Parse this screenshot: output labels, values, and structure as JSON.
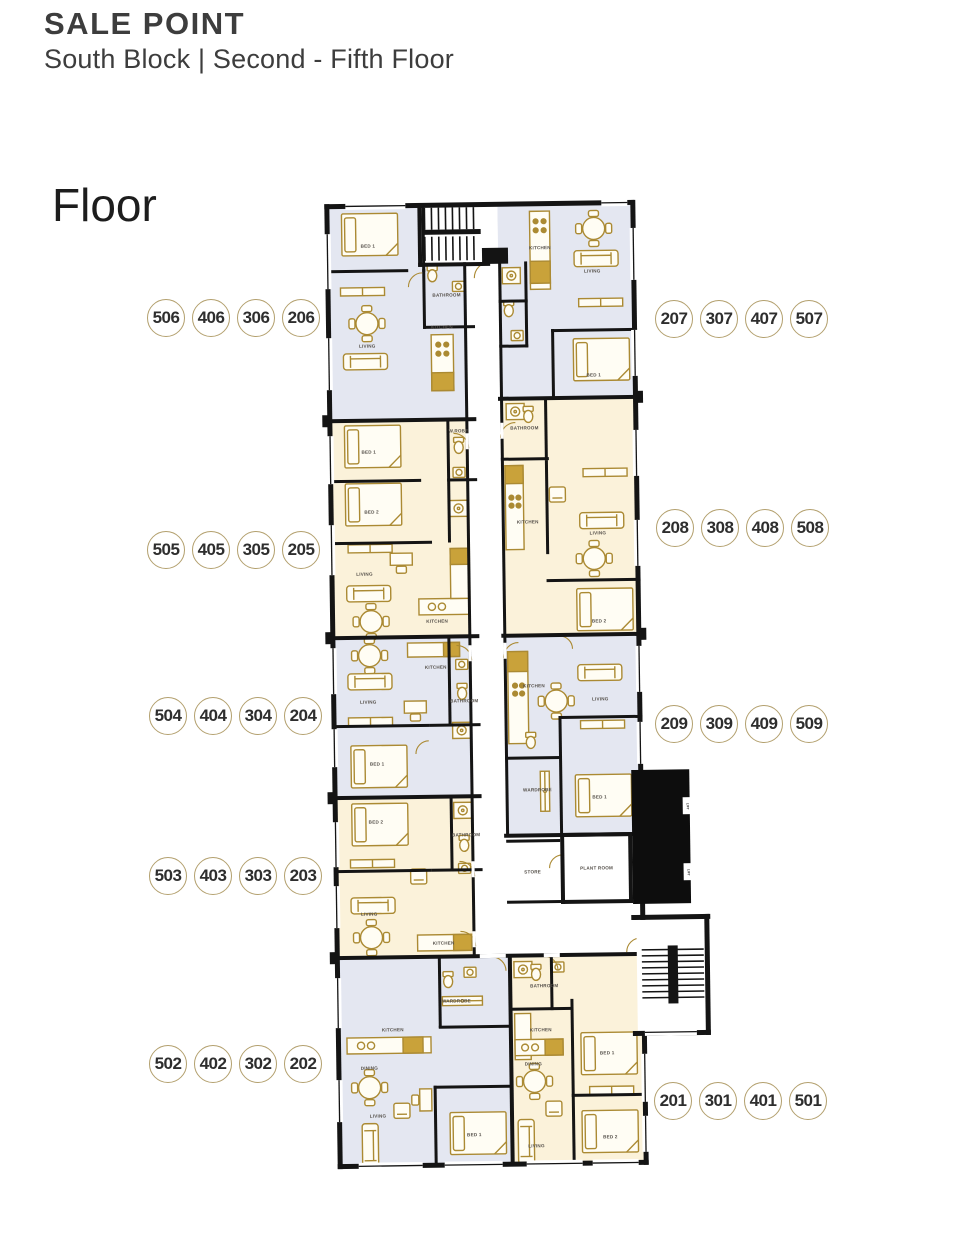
{
  "header": {
    "title": "SALE POINT",
    "subtitle": "South Block | Second - Fifth Floor"
  },
  "floor_label": "Floor",
  "unit_circles": {
    "left": [
      [
        "506",
        "406",
        "306",
        "206"
      ],
      [
        "505",
        "405",
        "305",
        "205"
      ],
      [
        "504",
        "404",
        "304",
        "204"
      ],
      [
        "503",
        "403",
        "303",
        "203"
      ],
      [
        "502",
        "402",
        "302",
        "202"
      ]
    ],
    "right": [
      [
        "207",
        "307",
        "407",
        "507"
      ],
      [
        "208",
        "308",
        "408",
        "508"
      ],
      [
        "209",
        "309",
        "409",
        "509"
      ],
      [
        "201",
        "301",
        "401",
        "501"
      ]
    ]
  },
  "plan": {
    "colors": {
      "wall": "#141414",
      "unit_blue": "#e4e7f1",
      "unit_cream": "#fbf2da",
      "furniture_gold": "#ab8a33",
      "circle_border": "#b3a06e"
    },
    "room_labels": [
      {
        "text": "BED 1",
        "x": 374,
        "y": 246
      },
      {
        "text": "BATHROOM",
        "x": 452,
        "y": 296
      },
      {
        "text": "LIVING",
        "x": 372,
        "y": 346
      },
      {
        "text": "KITCHEN",
        "x": 447,
        "y": 328
      },
      {
        "text": "KITCHEN",
        "x": 546,
        "y": 250
      },
      {
        "text": "LIVING",
        "x": 598,
        "y": 274
      },
      {
        "text": "BED 1",
        "x": 598,
        "y": 378
      },
      {
        "text": "BED 1",
        "x": 372,
        "y": 452
      },
      {
        "text": "BED 2",
        "x": 374,
        "y": 512
      },
      {
        "text": "W.ROBE",
        "x": 462,
        "y": 432
      },
      {
        "text": "LIVING",
        "x": 366,
        "y": 574
      },
      {
        "text": "KITCHEN",
        "x": 438,
        "y": 622
      },
      {
        "text": "BATHROOM",
        "x": 528,
        "y": 430
      },
      {
        "text": "KITCHEN",
        "x": 530,
        "y": 524
      },
      {
        "text": "LIVING",
        "x": 600,
        "y": 536
      },
      {
        "text": "BED 2",
        "x": 600,
        "y": 624
      },
      {
        "text": "LIVING",
        "x": 368,
        "y": 702
      },
      {
        "text": "KITCHEN",
        "x": 436,
        "y": 668
      },
      {
        "text": "BED 1",
        "x": 376,
        "y": 764
      },
      {
        "text": "BATHROOM",
        "x": 464,
        "y": 702
      },
      {
        "text": "KITCHEN",
        "x": 534,
        "y": 688
      },
      {
        "text": "LIVING",
        "x": 600,
        "y": 702
      },
      {
        "text": "WARDROBE",
        "x": 536,
        "y": 792
      },
      {
        "text": "BED 1",
        "x": 598,
        "y": 800
      },
      {
        "text": "BED 2",
        "x": 374,
        "y": 822
      },
      {
        "text": "BATHROOM",
        "x": 464,
        "y": 836
      },
      {
        "text": "LIVING",
        "x": 366,
        "y": 914
      },
      {
        "text": "KITCHEN",
        "x": 440,
        "y": 944
      },
      {
        "text": "STORE",
        "x": 530,
        "y": 874
      },
      {
        "text": "PLANT ROOM",
        "x": 594,
        "y": 871
      },
      {
        "text": "WARDROBE",
        "x": 452,
        "y": 1002
      },
      {
        "text": "KITCHEN",
        "x": 388,
        "y": 1030
      },
      {
        "text": "DINING",
        "x": 364,
        "y": 1068
      },
      {
        "text": "LIVING",
        "x": 372,
        "y": 1116
      },
      {
        "text": "BED 1",
        "x": 468,
        "y": 1136
      },
      {
        "text": "BATHROOM",
        "x": 540,
        "y": 988
      },
      {
        "text": "KITCHEN",
        "x": 536,
        "y": 1032
      },
      {
        "text": "DINING",
        "x": 528,
        "y": 1066
      },
      {
        "text": "LIVING",
        "x": 530,
        "y": 1148
      },
      {
        "text": "BED 1",
        "x": 602,
        "y": 1056
      },
      {
        "text": "BED 2",
        "x": 604,
        "y": 1140
      }
    ],
    "lift_labels": [
      {
        "text": "LIFT",
        "x": 685,
        "y": 809
      },
      {
        "text": "LIFT",
        "x": 685,
        "y": 875
      }
    ]
  }
}
